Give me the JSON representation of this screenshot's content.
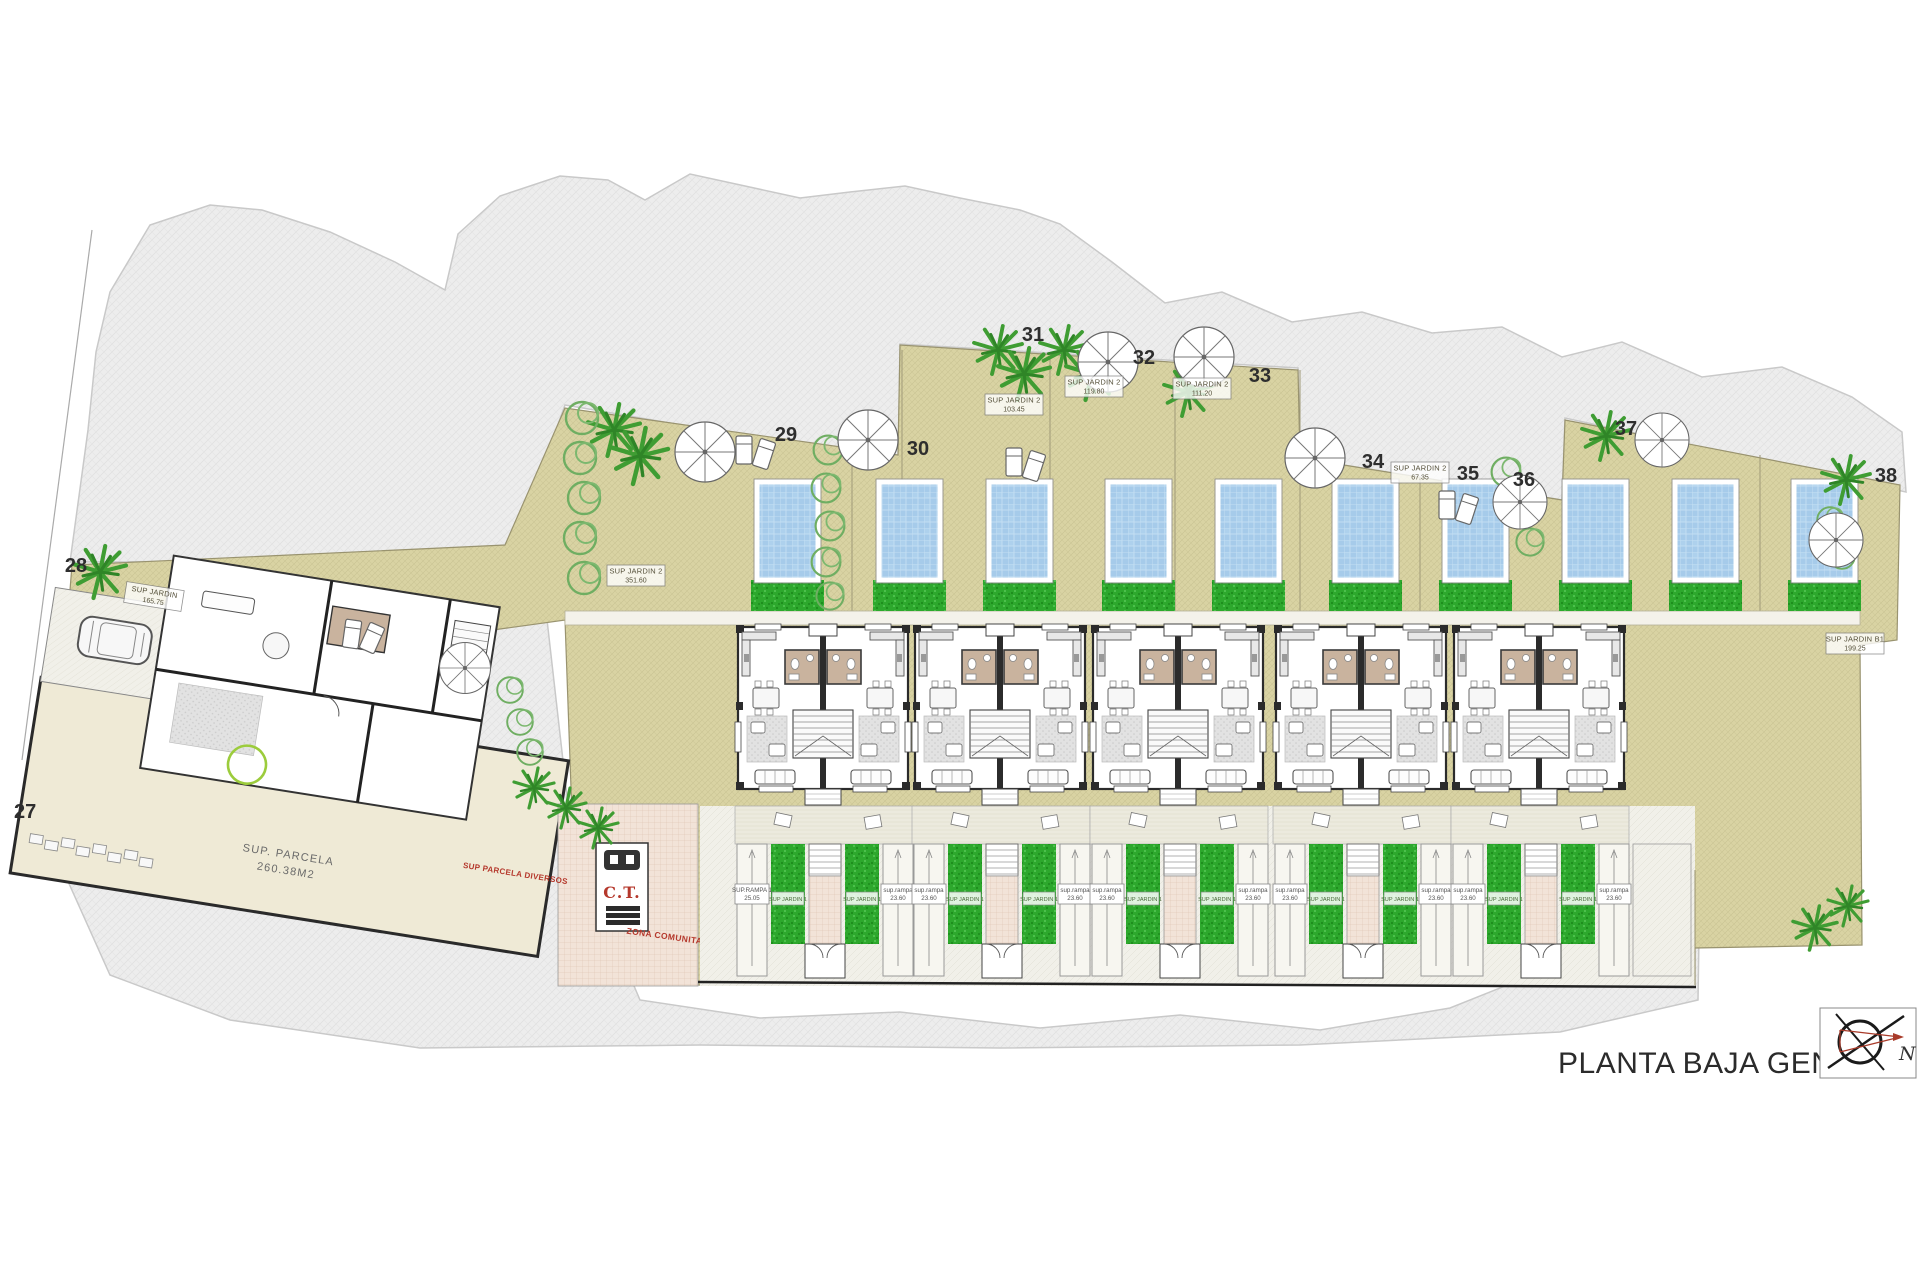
{
  "title": "PLANTA BAJA GENERAL",
  "compass": {
    "north": "N"
  },
  "plot_numbers": [
    "27",
    "28",
    "29",
    "30",
    "31",
    "32",
    "33",
    "34",
    "35",
    "36",
    "37",
    "38"
  ],
  "garden_labels": [
    {
      "line1": "SUP JARDIN",
      "line2": "165.75"
    },
    {
      "line1": "SUP JARDIN 2",
      "line2": "351.60"
    },
    {
      "line1": "SUP JARDIN 2",
      "line2": "103.45"
    },
    {
      "line1": "SUP JARDIN 2",
      "line2": "119.80"
    },
    {
      "line1": "SUP JARDIN 2",
      "line2": "111.20"
    },
    {
      "line1": "SUP JARDIN 2",
      "line2": "67.35"
    },
    {
      "line1": "SUP JARDIN B1",
      "line2": "199.25"
    }
  ],
  "left_house": {
    "rampa": {
      "line1": "sup.rampa",
      "line2": "23.20"
    },
    "parcela": {
      "line1": "SUP. PARCELA",
      "line2": "260.38M2"
    }
  },
  "red_labels": {
    "parcela_diversos": "SUP PARCELA DIVERSOS",
    "zona_comunitaria": "ZONA COMUNITARIA",
    "ct": "C.T."
  },
  "driveway": {
    "first_rampa": {
      "line1": "SUP.RAMPA 1",
      "line2": "25.05"
    },
    "rampa": {
      "line1": "sup.rampa",
      "line2": "23.60"
    },
    "jardin1": "SUP JARDIN 1"
  },
  "colors": {
    "terrain": "#ececec",
    "plot": "#d9d3a3",
    "pool": "#a6cbea",
    "lawn": "#2da82d",
    "accent_red": "#b5382c"
  }
}
